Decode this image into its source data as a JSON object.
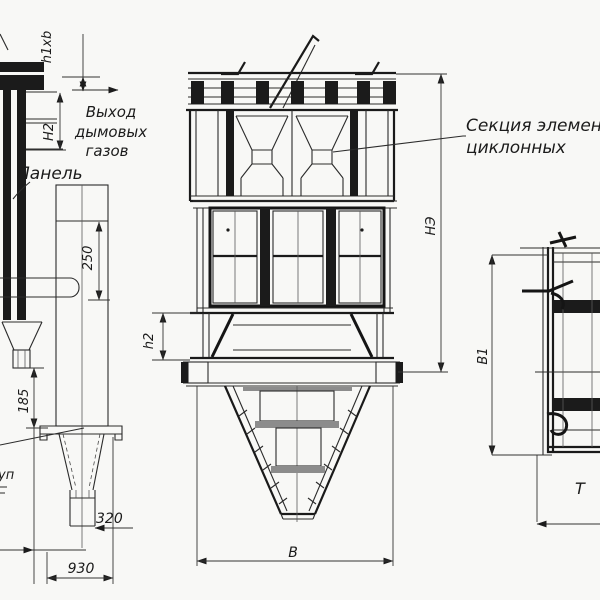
{
  "colors": {
    "background": "#f8f8f6",
    "line": "#1c1c1c"
  },
  "annotations": {
    "gas_outlet": {
      "line1": "Выход",
      "line2": "дымовых",
      "line3": "газов"
    },
    "panel": "Панель",
    "cyclone_section": {
      "line1": "Секция элемен",
      "line2": "циклонных"
    },
    "left_edge_fragment": "уп",
    "right_edge_fragment": "Т"
  },
  "dimensions": {
    "h1xb": "h1xb",
    "H2": "H2",
    "d250": "250",
    "d185": "185",
    "d320": "320",
    "d930": "930",
    "h2": "h2",
    "B": "В",
    "NE": "НЭ",
    "B1": "В1"
  }
}
